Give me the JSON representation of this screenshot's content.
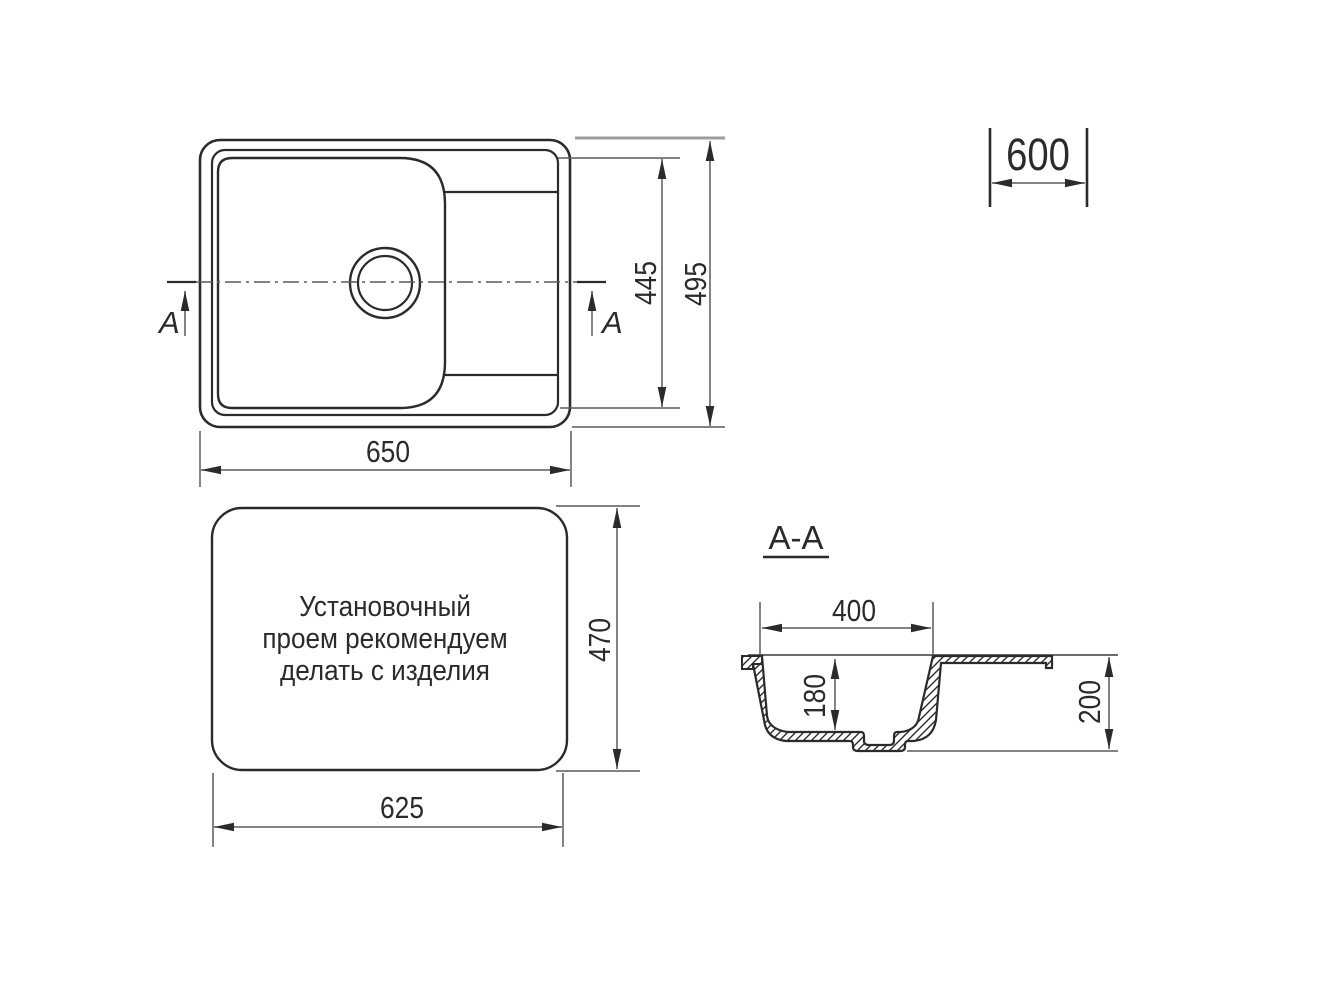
{
  "drawing": {
    "kind": "kitchen sink installation drawing",
    "plan_view": {
      "section_label_left": "A",
      "section_label_right": "A",
      "dim_overall_length": "650",
      "dim_bowl_area_width": "445",
      "dim_overall_width": "495"
    },
    "cabinet_dimension": {
      "value": "600"
    },
    "cutout_view": {
      "note": [
        "Установочный",
        "проем рекомендуем",
        "делать с изделия"
      ],
      "dim_cutout_length": "625",
      "dim_cutout_width": "470"
    },
    "section_view": {
      "title": "A-A",
      "dim_bowl_inner_width": "400",
      "dim_bowl_depth": "180",
      "dim_overall_depth": "200"
    },
    "colors": {
      "background": "#ffffff",
      "object_line": "#2b2b2b",
      "dimension_line": "#5a5a5a",
      "text": "#2b2b2b"
    }
  }
}
